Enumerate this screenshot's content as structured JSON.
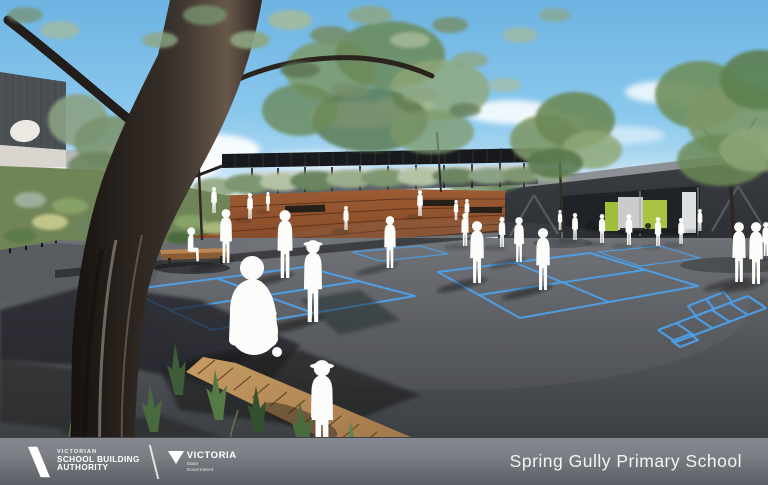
{
  "banner": {
    "vsba_logo": {
      "line1": "VICTORIAN",
      "line2": "SCHOOL BUILDING",
      "line3": "AUTHORITY"
    },
    "victoria_logo": {
      "name": "VICTORIA",
      "sub_line1": "State",
      "sub_line2": "Government"
    },
    "school_name": "Spring Gully Primary School"
  },
  "scene": {
    "type": "architectural-render",
    "elements": [
      "sky",
      "clouds",
      "eucalyptus-tree",
      "left-building",
      "shade-canopy",
      "timber-amphitheatre",
      "right-building",
      "asphalt-courtyard",
      "court-markings",
      "hopscotch",
      "children-silhouettes",
      "garden-beds",
      "boardwalk",
      "handrail",
      "bench"
    ],
    "colors": {
      "sky_top": "#6db3e2",
      "sky_horizon": "#ecf5fa",
      "asphalt_near": "#3c3f43",
      "asphalt_far": "#6e7175",
      "court_line_blue": "#4f9ee3",
      "timber_tiers": "#8c4f2e",
      "boardwalk_timber": "#b5854f",
      "canopy_dark": "#17191c",
      "building_charcoal": "#33373b",
      "accent_lime_green": "#a3c13d",
      "figure_white": "#fcfcfa",
      "banner_gray": "#6e7177"
    }
  }
}
